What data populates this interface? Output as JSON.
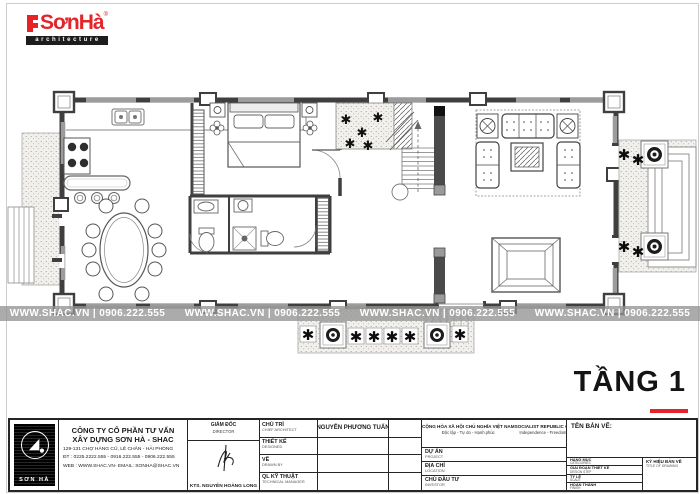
{
  "logo": {
    "brand": "SơnHà",
    "registered": "®",
    "tagline": "architecture"
  },
  "floor": {
    "title": "TẦNG 1"
  },
  "watermark": {
    "text": "WWW.SHAC.VN | 0906.222.555"
  },
  "title_block": {
    "company": {
      "logo_text": "SƠN HÀ",
      "name_line1": "CÔNG TY CỔ PHẦN TƯ VẤN",
      "name_line2": "XÂY DỰNG SƠN HÀ - SHAC",
      "address": "129-131 CHỢ HÀNG CŨ, LÊ CHÂN - HẢI PHÒNG",
      "phone": "ĐT : 0225.2222.555 - 0916.222.555 - 0906.222.555",
      "web": "WEB : WWW.SHAC.VN- EMAIL: SONHA@SHAC.VN"
    },
    "director": {
      "label_vi": "GIÁM ĐỐC",
      "label_en": "DIRECTOR",
      "name": "KTS. NGUYỄN HOÀNG LONG"
    },
    "personnel": {
      "rows": [
        {
          "label_vi": "CHỦ TRÌ",
          "label_en": "CHIEF ARCHITECT",
          "value": "NGUYỄN PHƯƠNG TUẤN"
        },
        {
          "label_vi": "THIẾT KẾ",
          "label_en": "DESIGNED",
          "value": ""
        },
        {
          "label_vi": "VẼ",
          "label_en": "DRAWN BY",
          "value": ""
        },
        {
          "label_vi": "QL KỸ THUẬT",
          "label_en": "TECHNICAL MANAGER",
          "value": ""
        }
      ]
    },
    "republic": {
      "header_vi_1": "CỘNG HÒA XÃ HỘI CHỦ NGHĨA VIỆT NAM",
      "header_vi_2": "Độc lập - Tự do - Hạnh phúc",
      "header_en_1": "SOCIALIST REPUBLIC OF VIET NAM",
      "header_en_2": "Independence - Freedom - Happiness",
      "rows": [
        {
          "label_vi": "DỰ ÁN",
          "label_en": "PROJECT"
        },
        {
          "label_vi": "ĐỊA CHỈ",
          "label_en": "LOCATION"
        },
        {
          "label_vi": "CHỦ ĐẦU TƯ",
          "label_en": "INVESTOR"
        }
      ]
    },
    "drawing": {
      "name_label": "TÊN BẢN VẼ:",
      "fields": [
        {
          "label_vi": "HẠNG MỤC",
          "label_en": "CATEGORIES"
        },
        {
          "label_vi": "GIAI ĐOẠN THIẾT KẾ",
          "label_en": "DESIGN STEP"
        },
        {
          "label_vi": "TỶ LỆ",
          "label_en": "SCALE"
        },
        {
          "label_vi": "HOÀN THÀNH",
          "label_en": "FINISH"
        }
      ],
      "code_label_vi": "KÝ HIỆU BẢN VẼ",
      "code_label_en": "TITLE OF DRAWING"
    }
  },
  "colors": {
    "brand_red": "#e5242a",
    "wall": "#3f3f3f",
    "window_fill": "#9c9c9c",
    "watermark_bg": "#949494"
  }
}
